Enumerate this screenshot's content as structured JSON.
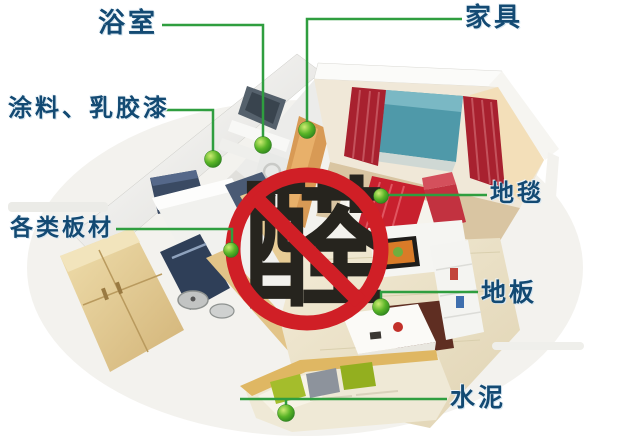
{
  "center": {
    "character": "醛"
  },
  "labels": [
    {
      "id": "bathroom",
      "text": "浴室"
    },
    {
      "id": "furniture",
      "text": "家具"
    },
    {
      "id": "paint",
      "text": "涂料、乳胶漆"
    },
    {
      "id": "boards",
      "text": "各类板材"
    },
    {
      "id": "carpet",
      "text": "地毯"
    },
    {
      "id": "floor",
      "text": "地板"
    },
    {
      "id": "cement",
      "text": "水泥"
    }
  ],
  "colors": {
    "label_text": "#134a73",
    "callout_line": "#2f9e3f",
    "callout_dot": "#59b427",
    "prohibition_ring": "#d01f26",
    "center_character": "#26241e"
  }
}
